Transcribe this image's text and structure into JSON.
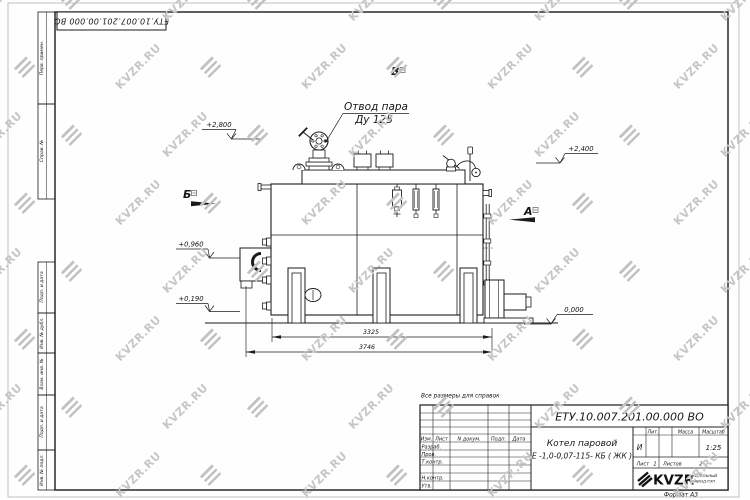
{
  "watermark": {
    "text": "KVZR.RU"
  },
  "corner_stamp": {
    "doc_number": "ЕТУ.10.007.201.00.000  ВО"
  },
  "frame_left": {
    "cells": [
      {
        "label": "Перв. примен."
      },
      {
        "label": "Справ. №"
      },
      {
        "label": "Подп. и дата"
      },
      {
        "label": "Инв. № дубл."
      },
      {
        "label": "Взам. инв. №"
      },
      {
        "label": "Подп. и дата"
      },
      {
        "label": "Инв. № подл."
      }
    ]
  },
  "drawing": {
    "callout_line1": "Отвод пара",
    "callout_line2": "Ду 125",
    "views": {
      "b": "Б",
      "v": "В",
      "a": "А"
    },
    "elevations": {
      "e2800": "+2,800",
      "e2400": "+2,400",
      "e0960": "+0,960",
      "e0190": "+0,190",
      "e0000": "0,000"
    },
    "dimensions": {
      "inner": "3325",
      "outer": "3746"
    }
  },
  "note": "Все размеры для справок",
  "title_block": {
    "doc_number": "ЕТУ.10.007.201.00.000  ВО",
    "product_name": "Котел паровой",
    "product_type": "Е -1,0-0,07-115- КБ ( ЖК )",
    "cols": {
      "izm": "Изм.",
      "list": "Лист",
      "doc": "N докум.",
      "sign": "Подп.",
      "date": "Дата"
    },
    "rows": {
      "razrab": "Разраб.",
      "prov": "Пров.",
      "tkontr": "Т.контр.",
      "nkontr": "Н.контр.",
      "utv": "Утв."
    },
    "lit": {
      "label": "Лит.",
      "value": "И"
    },
    "mass": {
      "label": "Масса",
      "value": ""
    },
    "scale": {
      "label": "Масштаб",
      "value": "1:25"
    },
    "sheet": {
      "label": "Лист",
      "value": "1"
    },
    "sheets": {
      "label": "Листов",
      "value": "2"
    },
    "company": {
      "logo": "KVZR",
      "sub1": "КОТЕЛЬНЫЙ",
      "sub2": "ЗАВОД РЭП"
    },
    "format": "Формат  А3"
  }
}
